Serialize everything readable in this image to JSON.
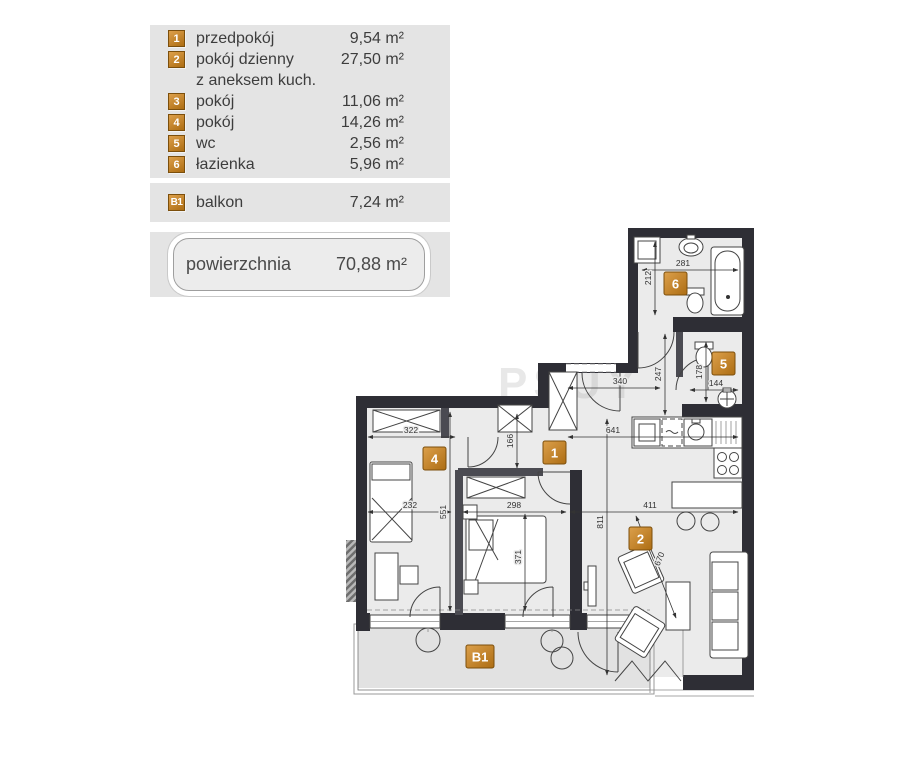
{
  "legend": {
    "rooms": [
      {
        "num": "1",
        "name": "przedpokój",
        "area": "9,54 m²"
      },
      {
        "num": "2",
        "name": "pokój dzienny",
        "note": "z aneksem kuch.",
        "area": "27,50 m²"
      },
      {
        "num": "3",
        "name": "pokój",
        "area": "11,06 m²"
      },
      {
        "num": "4",
        "name": "pokój",
        "area": "14,26 m²"
      },
      {
        "num": "5",
        "name": "wc",
        "area": "2,56 m²"
      },
      {
        "num": "6",
        "name": "łazienka",
        "area": "5,96 m²"
      }
    ],
    "balcony": {
      "num": "B1",
      "name": "balkon",
      "area": "7,24 m²"
    },
    "total": {
      "label": "powierzchnia",
      "area": "70,88 m²"
    }
  },
  "plan": {
    "labels": {
      "r1": "1",
      "r2": "2",
      "r4": "4",
      "r5": "5",
      "r6": "6",
      "b1": "B1"
    },
    "dims": {
      "d322": "322",
      "d166": "166",
      "d641": "641",
      "d232": "232",
      "d298": "298",
      "d551": "551",
      "d371": "371",
      "d811": "811",
      "d411": "411",
      "d340": "340",
      "d247": "247",
      "d178": "178",
      "d144": "144",
      "d281": "281",
      "d212": "212",
      "d670": "670"
    },
    "watermark": "PSUY"
  },
  "colors": {
    "accent": "#bf7d1e",
    "wall": "#2e2e35",
    "floor": "#ebebeb",
    "balcony_floor": "#e2e2e2",
    "panel_bg": "#e4e4e4"
  }
}
